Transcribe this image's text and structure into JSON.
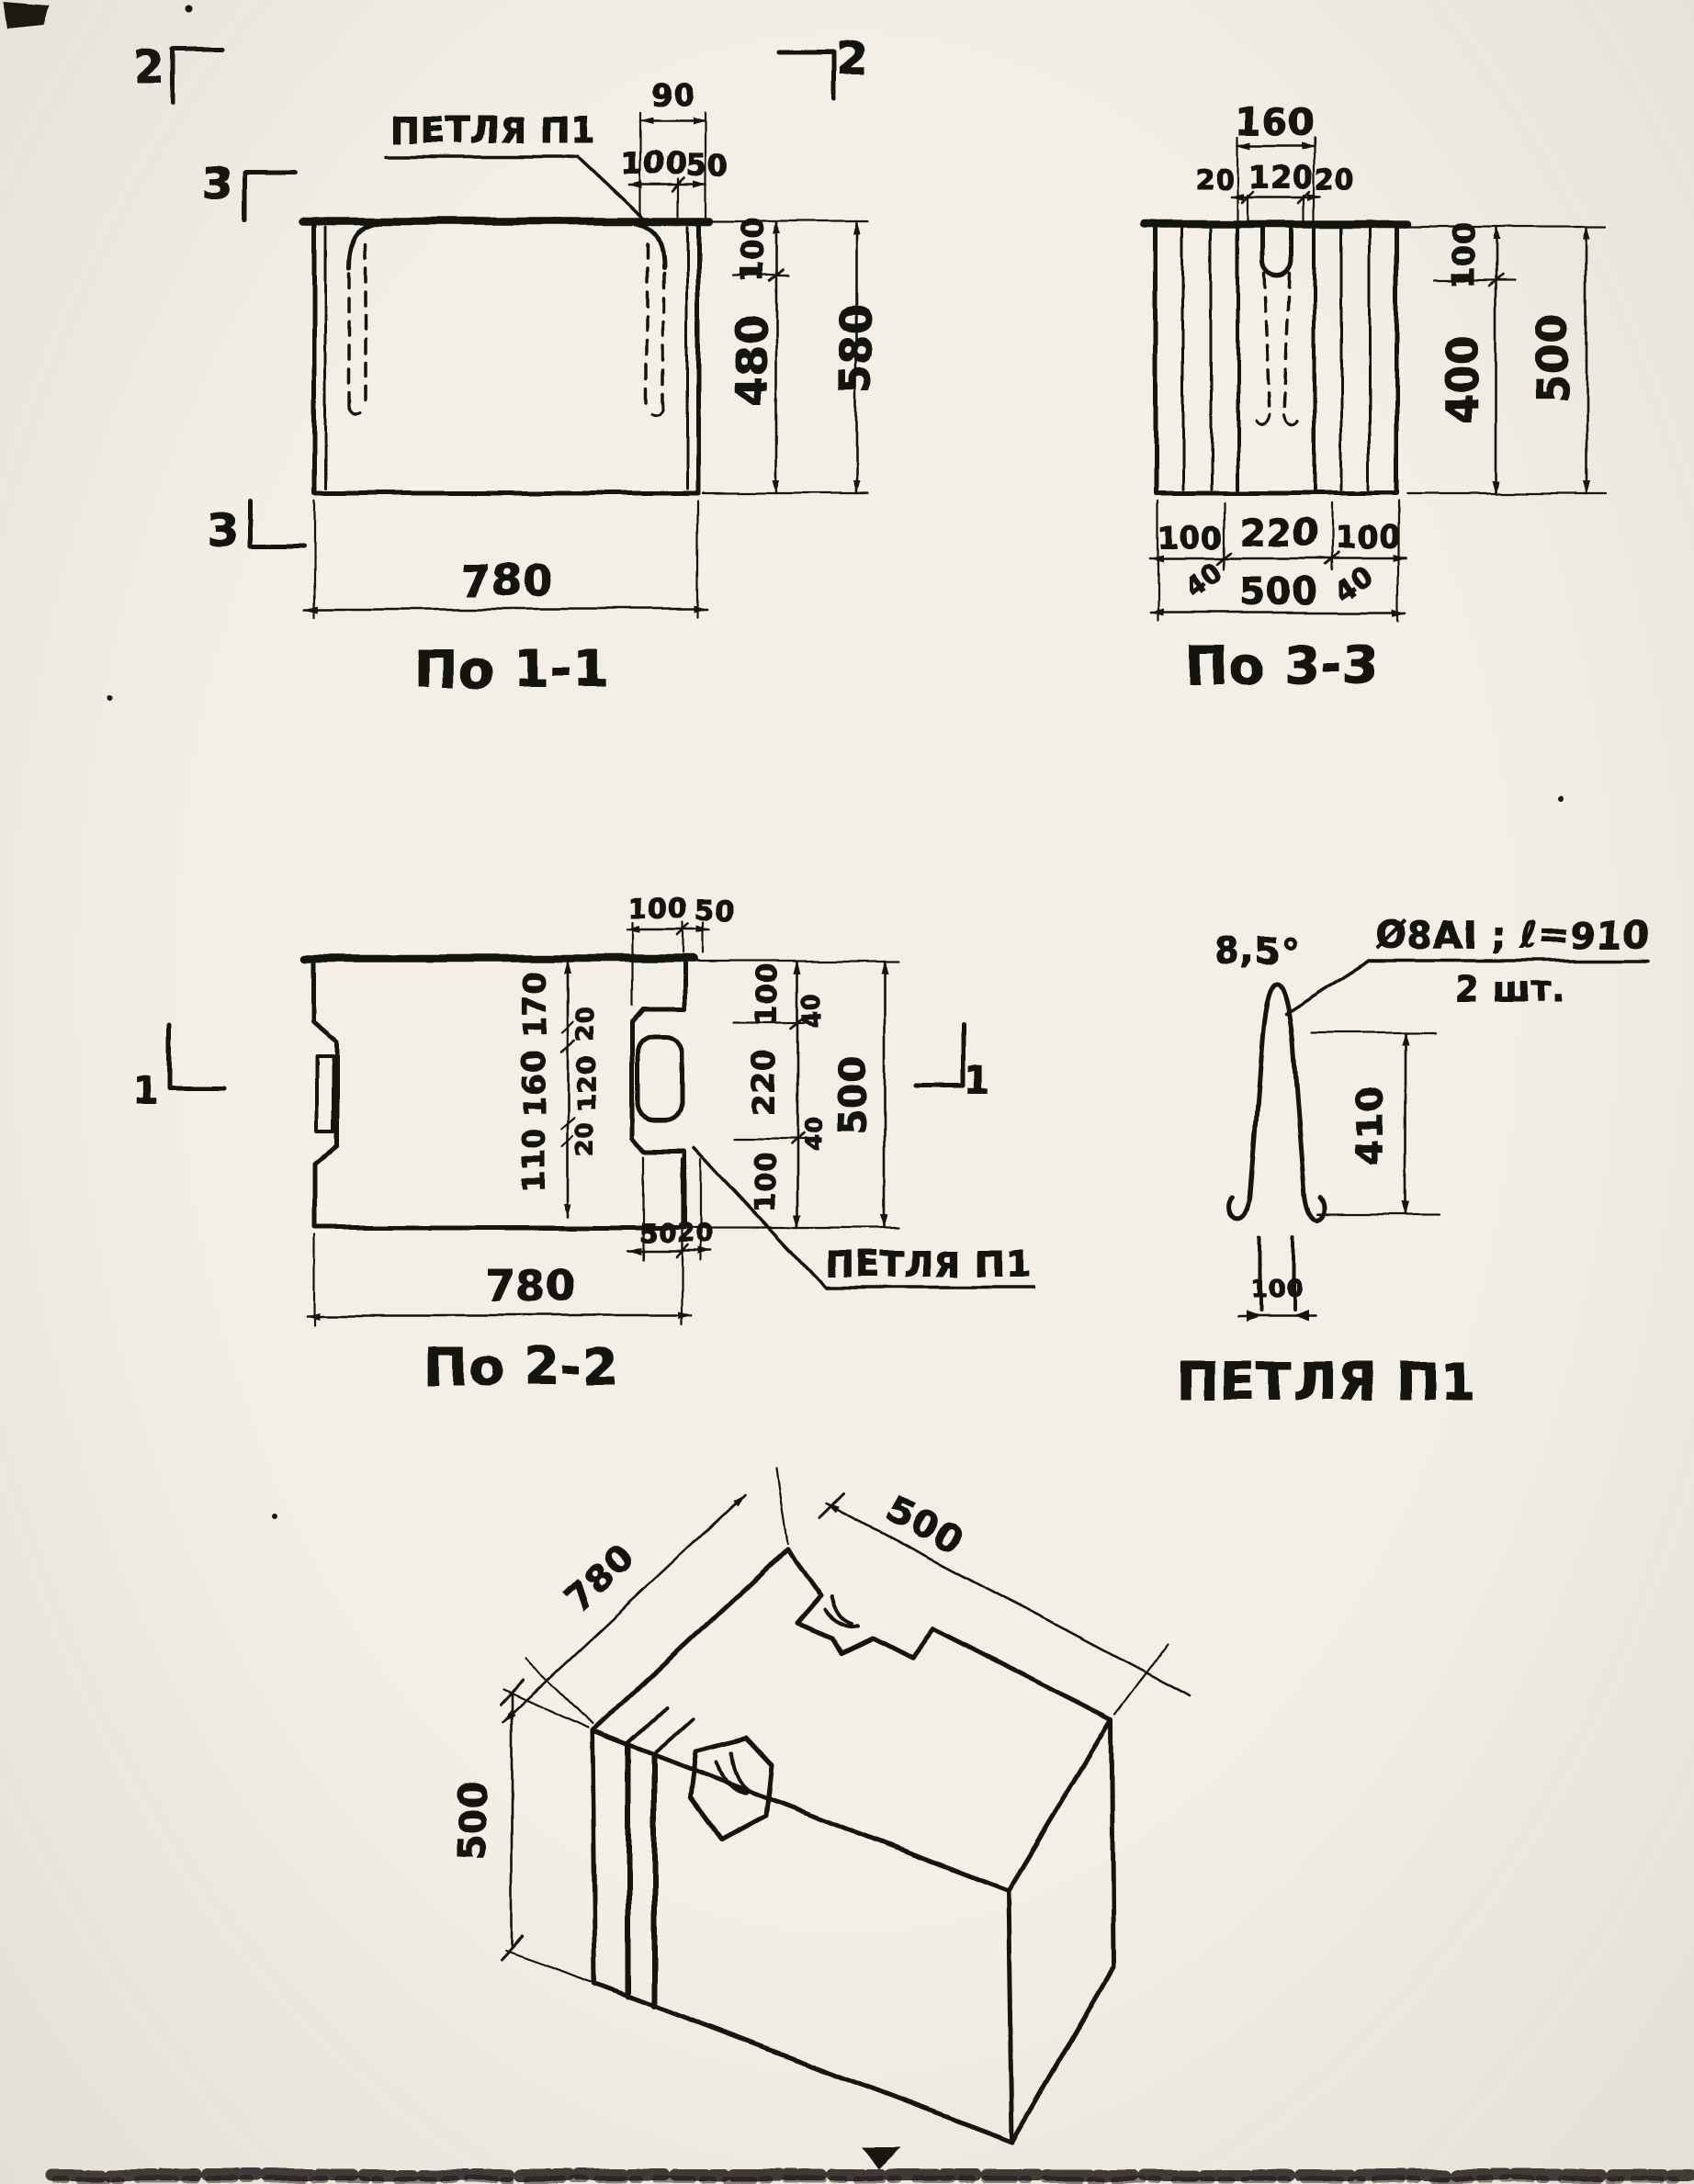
{
  "page": {
    "background": "#ebe8e0",
    "ink": "#1d1a16",
    "type": "scanned-blueprint"
  },
  "section11": {
    "caption": "По 1-1",
    "loop_label": "ПЕТЛЯ П1",
    "dim_90": "90",
    "dim_100_top": "100",
    "dim_50_top": "50",
    "dim_100_right": "100",
    "dim_480": "480",
    "dim_580": "580",
    "dim_780": "780",
    "mark_2_left": "2",
    "mark_2_right": "2",
    "mark_3_upper": "3",
    "mark_3_lower": "3"
  },
  "section33": {
    "caption": "По 3-3",
    "dim_160": "160",
    "dim_20_left": "20",
    "dim_120": "120",
    "dim_20_right": "20",
    "dim_100_right": "100",
    "dim_400": "400",
    "dim_500_right": "500",
    "dim_100_bl": "100",
    "dim_220": "220",
    "dim_100_br": "100",
    "dim_40_left": "40",
    "dim_40_right": "40",
    "dim_500_bottom": "500"
  },
  "section22": {
    "caption": "По 2-2",
    "loop_label": "ПЕТЛЯ П1",
    "dim_100_top": "100",
    "dim_50_top": "50",
    "dim_170": "170",
    "dim_160": "160",
    "dim_110": "110",
    "dim_20_a": "20",
    "dim_120": "120",
    "dim_20_b": "20",
    "dim_100_ra": "100",
    "dim_40_ra": "40",
    "dim_220": "220",
    "dim_40_rb": "40",
    "dim_100_rb": "100",
    "dim_500": "500",
    "dim_50_notch": "50",
    "dim_20_notch": "20",
    "dim_780": "780",
    "mark_1_left": "1",
    "mark_1_right": "1"
  },
  "loop_detail": {
    "caption": "ПЕТЛЯ П1",
    "note_line1": "Ø8АI ; ℓ=910",
    "note_line2": "2 шт.",
    "angle_note": "8,5°",
    "dim_410": "410",
    "dim_100": "100"
  },
  "isometric": {
    "dim_length": "780",
    "dim_depth": "500",
    "dim_height": "500"
  }
}
